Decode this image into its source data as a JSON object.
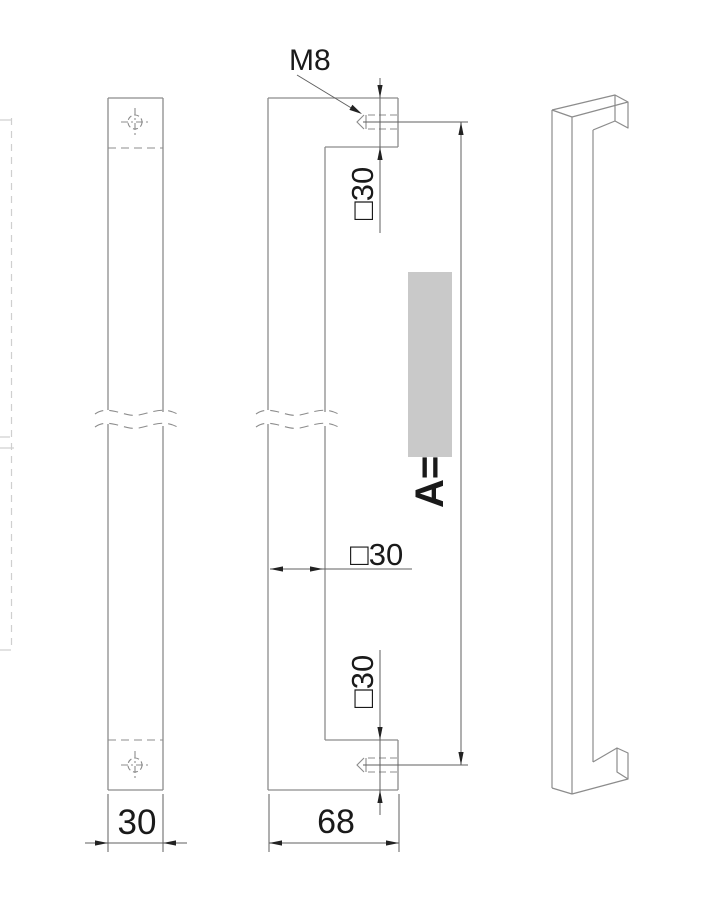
{
  "drawing": {
    "thread_label": "M8",
    "dim_top_foot": "□30",
    "dim_grip_section": "□30",
    "dim_bottom_foot": "□30",
    "dim_hole_distance": "A=",
    "dim_side_width": "30",
    "dim_front_depth": "68"
  },
  "colors": {
    "outline": "#8c8c8c",
    "dimension": "#5f5f5f",
    "arrow": "#222222",
    "text": "#1a1a1a",
    "highlight_box": "#c9c9c9",
    "page_mark": "#cfcfcf"
  }
}
